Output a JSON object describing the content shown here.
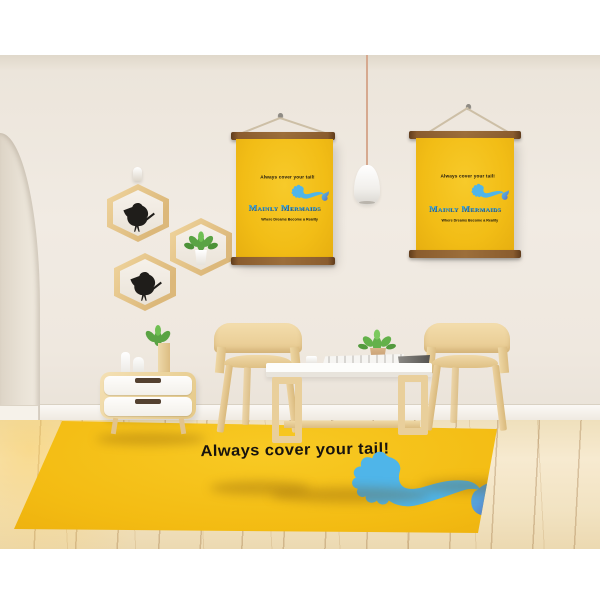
{
  "brand": {
    "top_tagline": "Always cover your tail!",
    "name": "Mainly Mermaids",
    "bottom_tagline": "Where Dreams Become a Reality"
  },
  "colors": {
    "canvas_yellow": "#F3BF17",
    "rug_yellow": "#F4BD14",
    "logo_blue": "#36A8E2",
    "logo_outline": "#28334E",
    "tagline_text": "#17130F",
    "mermaid_body": "#4FB5E9",
    "mermaid_fin": "#5E63B5",
    "wall": "#F0EAE2",
    "floor_wood": "#F3E4C3",
    "poster_bar_wood": "#84552A",
    "furniture_wood": "#EBD2A0"
  },
  "decor": {
    "wall_art": [
      "hanging-canvas-poster-left",
      "hanging-canvas-poster-right"
    ],
    "shelves": [
      {
        "shape": "hexagon",
        "content": "bird-figurine"
      },
      {
        "shape": "hexagon",
        "content": "potted-plant"
      },
      {
        "shape": "hexagon",
        "content": "bird-figurine"
      }
    ],
    "furniture": [
      "pendant-lamp",
      "nightstand",
      "wooden-chair",
      "coffee-table",
      "wooden-chair",
      "branded-rug"
    ],
    "doorway": "arch"
  }
}
